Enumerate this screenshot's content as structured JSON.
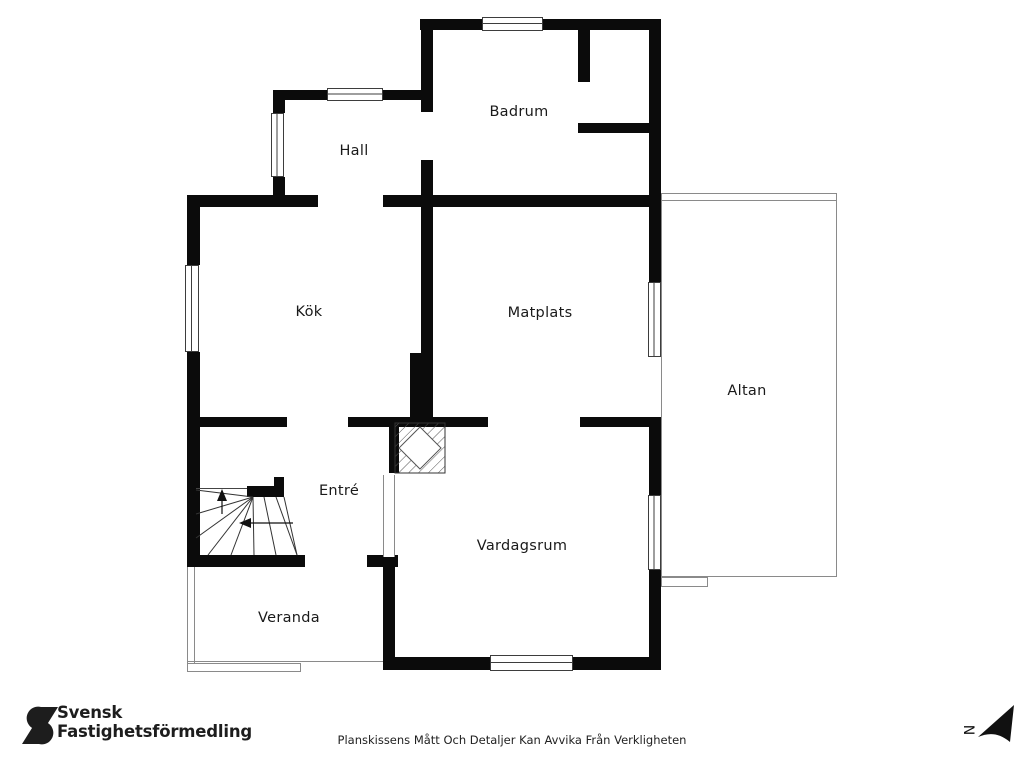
{
  "rooms": {
    "badrum": {
      "label": "Badrum"
    },
    "hall": {
      "label": "Hall"
    },
    "kok": {
      "label": "Kök"
    },
    "matplats": {
      "label": "Matplats"
    },
    "altan": {
      "label": "Altan"
    },
    "entre": {
      "label": "Entré"
    },
    "vardagsrum": {
      "label": "Vardagsrum"
    },
    "veranda": {
      "label": "Veranda"
    }
  },
  "branding": {
    "logo_line1": "Svensk",
    "logo_line2": "Fastighetsförmedling"
  },
  "footer": {
    "disclaimer": "Planskissens Mått Och Detaljer Kan Avvika Från Verkligheten"
  },
  "compass": {
    "label": "N"
  },
  "colors": {
    "walls": "#0b0b0b",
    "thin_outlines": "#8a8a8a",
    "text": "#1a1a1a"
  }
}
